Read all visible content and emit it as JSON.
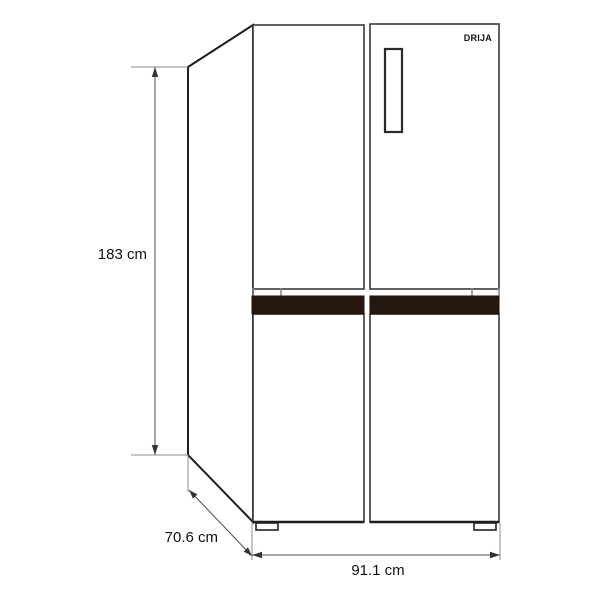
{
  "diagram": {
    "brand": "DRIJA",
    "product": "four-door-refrigerator-dimension-drawing",
    "dimensions": {
      "height": "183 cm",
      "depth": "70.6 cm",
      "width": "91.1 cm"
    },
    "colors": {
      "outline": "#1f1f1f",
      "dimension_line": "#4d4d4d",
      "handle_band": "#271711",
      "background": "#ffffff"
    }
  }
}
